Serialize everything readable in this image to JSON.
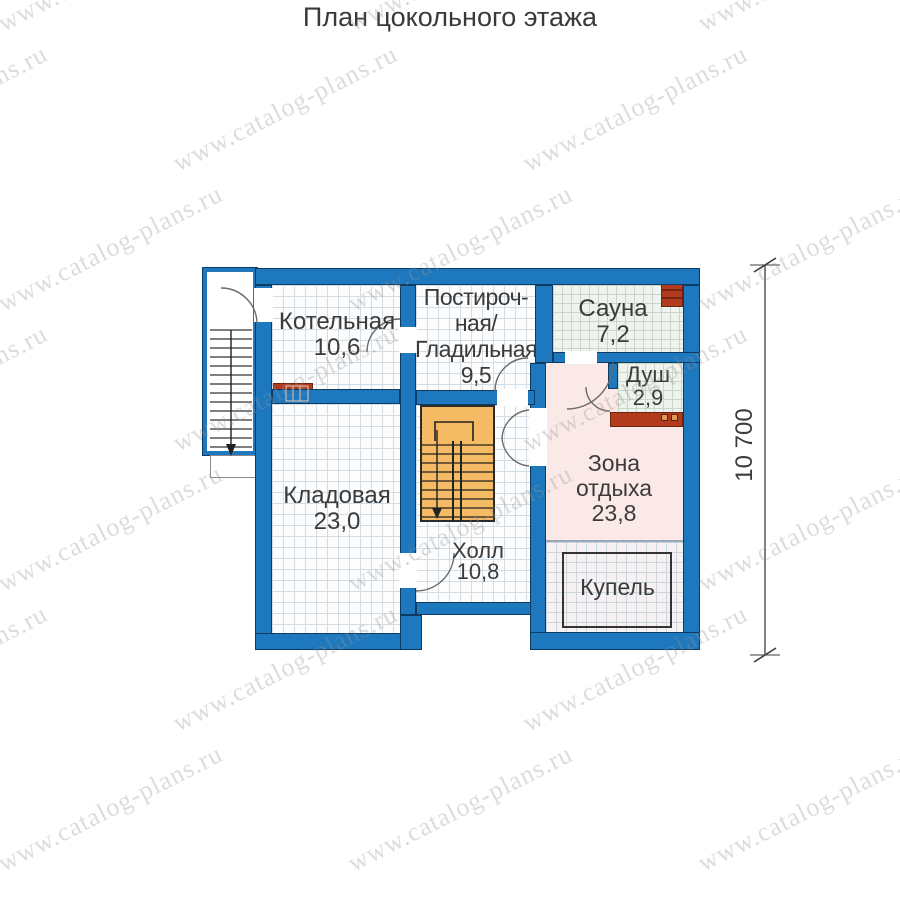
{
  "title": "План цокольного этажа",
  "watermark": {
    "text": "www.catalog-plans.ru"
  },
  "dimension": {
    "length": "10 700"
  },
  "rooms": [
    {
      "name": "Котельная",
      "area": "10,6",
      "label_lines": [
        "Котельная",
        "10,6"
      ]
    },
    {
      "name": "Постирочная/Гладильная",
      "area": "9,5",
      "label_lines": [
        "Постироч-",
        "ная/",
        "Гладильная",
        "9,5"
      ]
    },
    {
      "name": "Сауна",
      "area": "7,2",
      "label_lines": [
        "Сауна",
        "7,2"
      ]
    },
    {
      "name": "Душ",
      "area": "2,9",
      "label_lines": [
        "Душ",
        "2,9"
      ]
    },
    {
      "name": "Зона отдыха",
      "area": "23,8",
      "label_lines": [
        "Зона",
        "отдыха",
        "23,8"
      ]
    },
    {
      "name": "Кладовая",
      "area": "23,0",
      "label_lines": [
        "Кладовая",
        "23,0"
      ]
    },
    {
      "name": "Холл",
      "area": "10,8",
      "label_lines": [
        "Холл",
        "10,8"
      ]
    },
    {
      "name": "Купель",
      "area": "",
      "label_lines": [
        "Купель"
      ]
    }
  ],
  "fixtures": [
    "boiler",
    "sauna-stove",
    "shower-bench",
    "plunge-pool",
    "interior-stairs-down",
    "exterior-stairs-down"
  ],
  "colors": {
    "wall": "#1d78be",
    "wall_outline": "#0c3b63",
    "stairs": "#f4ba64",
    "fixture_red": "#b23b1d",
    "floor_grid": "#d2dde5",
    "sauna_floor": "#eef3ee",
    "rest_zone_floor": "#fbe9e7",
    "kupel_floor": "#f8f1f1",
    "text": "#3b3b3b",
    "watermark": "#9b9b9b"
  }
}
